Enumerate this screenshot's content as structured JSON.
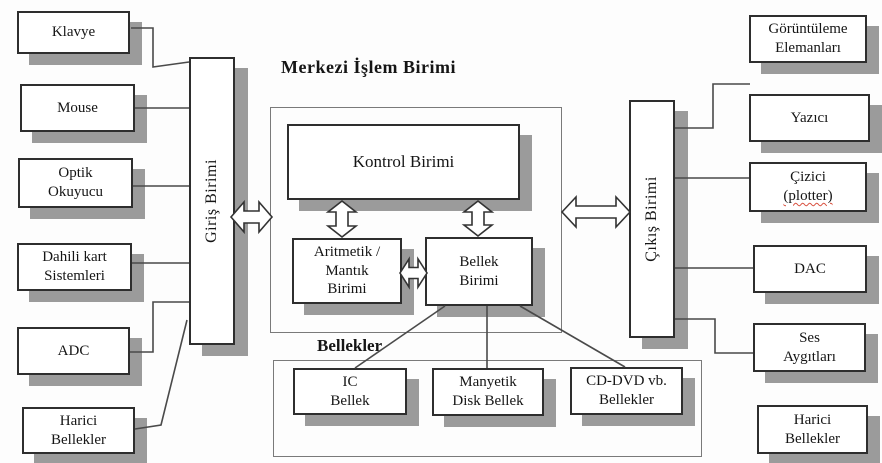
{
  "title": "Merkezi İşlem Birimi",
  "sections": {
    "memories_label": "Bellekler"
  },
  "inputs": {
    "klavye": "Klavye",
    "mouse": "Mouse",
    "optik": "Optik\nOkuyucu",
    "dahili": "Dahili kart\nSistemleri",
    "adc": "ADC",
    "harici": "Harici\nBellekler"
  },
  "units": {
    "giris": "Giriş Birimi",
    "kontrol": "Kontrol Birimi",
    "aritmetik": "Aritmetik /\nMantık\nBirimi",
    "bellek": "Bellek\nBirimi",
    "cikis": "Çıkış Birimi"
  },
  "memories": {
    "ic": "IC\nBellek",
    "manyetik": "Manyetik\nDisk Bellek",
    "cddvd": "CD-DVD vb.\nBellekler"
  },
  "outputs": {
    "goruntuleme": "Görüntüleme\nElemanları",
    "yazici": "Yazıcı",
    "cizici_line1": "Çizici",
    "cizici_line2": "(plotter)",
    "dac": "DAC",
    "ses": "Ses\nAygıtları",
    "harici": "Harici\nBellekler"
  },
  "colors": {
    "box_border": "#2e2e2e",
    "shadow": "#9b9b9b",
    "wire": "#4a4a4a",
    "container_border": "#7a7a7a",
    "spellcheck_underline": "#d9503f",
    "background": "#fdfdfd"
  }
}
